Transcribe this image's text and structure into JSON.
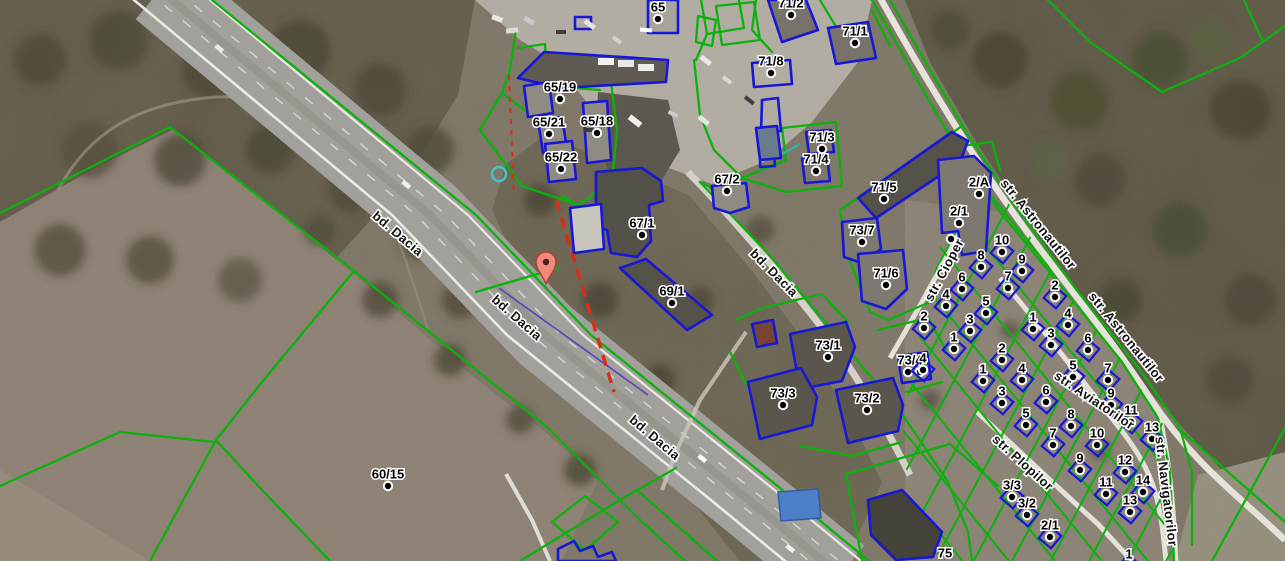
{
  "map": {
    "description": "Satellite cadastral map view",
    "colors": {
      "parcel_line_green": "#0cb20c",
      "building_outline_blue": "#1717d6",
      "selection_dash_red": "#d83018",
      "marker_fill": "#f18a7a",
      "selected_boundary_purple": "#5a35c0",
      "utility_cyan": "#3fc8c8",
      "utility_teal": "#2fb3aa"
    },
    "marker": {
      "x": 546,
      "y": 268,
      "icon": "map-pin-icon"
    },
    "street_labels": [
      {
        "text": "bd. Dacia",
        "x": 395,
        "y": 237,
        "angle": 40
      },
      {
        "text": "bd. Dacia",
        "x": 514,
        "y": 321,
        "angle": 41
      },
      {
        "text": "bd. Dacia",
        "x": 652,
        "y": 441,
        "angle": 40
      },
      {
        "text": "bd. Dacia",
        "x": 771,
        "y": 276,
        "angle": 45
      },
      {
        "text": "str. Astronautilor",
        "x": 1035,
        "y": 227,
        "angle": 51
      },
      {
        "text": "str. Astronautilor",
        "x": 1123,
        "y": 340,
        "angle": 51
      },
      {
        "text": "str. Cioper",
        "x": 948,
        "y": 272,
        "angle": -62
      },
      {
        "text": "str. Aviatorilor",
        "x": 1092,
        "y": 404,
        "angle": 34
      },
      {
        "text": "str. Plopilor",
        "x": 1020,
        "y": 466,
        "angle": 42
      },
      {
        "text": "str. Navigatorilor",
        "x": 1162,
        "y": 492,
        "angle": 83
      }
    ],
    "parcel_labels": [
      {
        "t": "65",
        "x": 658,
        "y": 7
      },
      {
        "t": "71/2",
        "x": 791,
        "y": 3
      },
      {
        "t": "71/8",
        "x": 771,
        "y": 61
      },
      {
        "t": "71/1",
        "x": 855,
        "y": 31
      },
      {
        "t": "65/19",
        "x": 560,
        "y": 87
      },
      {
        "t": "65/21",
        "x": 549,
        "y": 122
      },
      {
        "t": "65/18",
        "x": 597,
        "y": 121
      },
      {
        "t": "65/22",
        "x": 561,
        "y": 157
      },
      {
        "t": "71/3",
        "x": 822,
        "y": 137
      },
      {
        "t": "71/4",
        "x": 816,
        "y": 159
      },
      {
        "t": "67/2",
        "x": 727,
        "y": 179
      },
      {
        "t": "67/1",
        "x": 642,
        "y": 223
      },
      {
        "t": "69/1",
        "x": 672,
        "y": 291
      },
      {
        "t": "71/5",
        "x": 884,
        "y": 187
      },
      {
        "t": "2/A",
        "x": 979,
        "y": 182
      },
      {
        "t": "2/1",
        "x": 959,
        "y": 211
      },
      {
        "t": "",
        "x": 951,
        "y": 227
      },
      {
        "t": "73/7",
        "x": 862,
        "y": 230
      },
      {
        "t": "71/6",
        "x": 886,
        "y": 273
      },
      {
        "t": "73/1",
        "x": 828,
        "y": 345
      },
      {
        "t": "73/4",
        "x": 910,
        "y": 360,
        "dots": [
          [
            908,
            372
          ],
          [
            920,
            372
          ]
        ]
      },
      {
        "t": "73/3",
        "x": 783,
        "y": 393
      },
      {
        "t": "73/2",
        "x": 867,
        "y": 398
      },
      {
        "t": "60/15",
        "x": 388,
        "y": 474
      },
      {
        "t": "75",
        "x": 945,
        "y": 553,
        "nodot": true
      },
      {
        "t": "1",
        "x": 1129,
        "y": 554,
        "house": true
      },
      {
        "t": "10",
        "x": 1002,
        "y": 240,
        "house": true
      },
      {
        "t": "8",
        "x": 981,
        "y": 255,
        "house": true
      },
      {
        "t": "9",
        "x": 1022,
        "y": 259,
        "house": true
      },
      {
        "t": "6",
        "x": 962,
        "y": 277,
        "house": true
      },
      {
        "t": "7",
        "x": 1008,
        "y": 276,
        "house": true
      },
      {
        "t": "2",
        "x": 1055,
        "y": 285,
        "house": true
      },
      {
        "t": "4",
        "x": 946,
        "y": 294,
        "house": true
      },
      {
        "t": "5",
        "x": 986,
        "y": 301,
        "house": true
      },
      {
        "t": "2",
        "x": 924,
        "y": 316,
        "house": true
      },
      {
        "t": "3",
        "x": 970,
        "y": 319,
        "house": true
      },
      {
        "t": "1",
        "x": 954,
        "y": 337,
        "house": true
      },
      {
        "t": "4",
        "x": 923,
        "y": 358,
        "house": true
      },
      {
        "t": "1",
        "x": 1033,
        "y": 317,
        "house": true
      },
      {
        "t": "4",
        "x": 1068,
        "y": 313,
        "house": true
      },
      {
        "t": "3",
        "x": 1051,
        "y": 333,
        "house": true
      },
      {
        "t": "6",
        "x": 1088,
        "y": 338,
        "house": true
      },
      {
        "t": "2",
        "x": 1002,
        "y": 348,
        "house": true
      },
      {
        "t": "5",
        "x": 1073,
        "y": 365,
        "house": true
      },
      {
        "t": "7",
        "x": 1108,
        "y": 368,
        "house": true
      },
      {
        "t": "4",
        "x": 1022,
        "y": 368,
        "house": true
      },
      {
        "t": "1",
        "x": 983,
        "y": 369,
        "house": true
      },
      {
        "t": "6",
        "x": 1046,
        "y": 390,
        "house": true
      },
      {
        "t": "3",
        "x": 1002,
        "y": 391,
        "house": true
      },
      {
        "t": "9",
        "x": 1111,
        "y": 393,
        "house": true
      },
      {
        "t": "11",
        "x": 1131,
        "y": 410,
        "house": true
      },
      {
        "t": "5",
        "x": 1026,
        "y": 413,
        "house": true
      },
      {
        "t": "8",
        "x": 1071,
        "y": 414,
        "house": true
      },
      {
        "t": "13",
        "x": 1152,
        "y": 427,
        "house": true
      },
      {
        "t": "7",
        "x": 1053,
        "y": 433,
        "house": true
      },
      {
        "t": "10",
        "x": 1097,
        "y": 433,
        "house": true
      },
      {
        "t": "9",
        "x": 1080,
        "y": 458,
        "house": true
      },
      {
        "t": "12",
        "x": 1125,
        "y": 460,
        "house": true
      },
      {
        "t": "11",
        "x": 1106,
        "y": 482,
        "house": true
      },
      {
        "t": "14",
        "x": 1143,
        "y": 480,
        "house": true
      },
      {
        "t": "13",
        "x": 1130,
        "y": 500,
        "house": true
      },
      {
        "t": "3/3",
        "x": 1012,
        "y": 485,
        "house": true
      },
      {
        "t": "3/2",
        "x": 1027,
        "y": 503,
        "house": true
      },
      {
        "t": "2/1",
        "x": 1050,
        "y": 525,
        "house": true
      }
    ]
  }
}
